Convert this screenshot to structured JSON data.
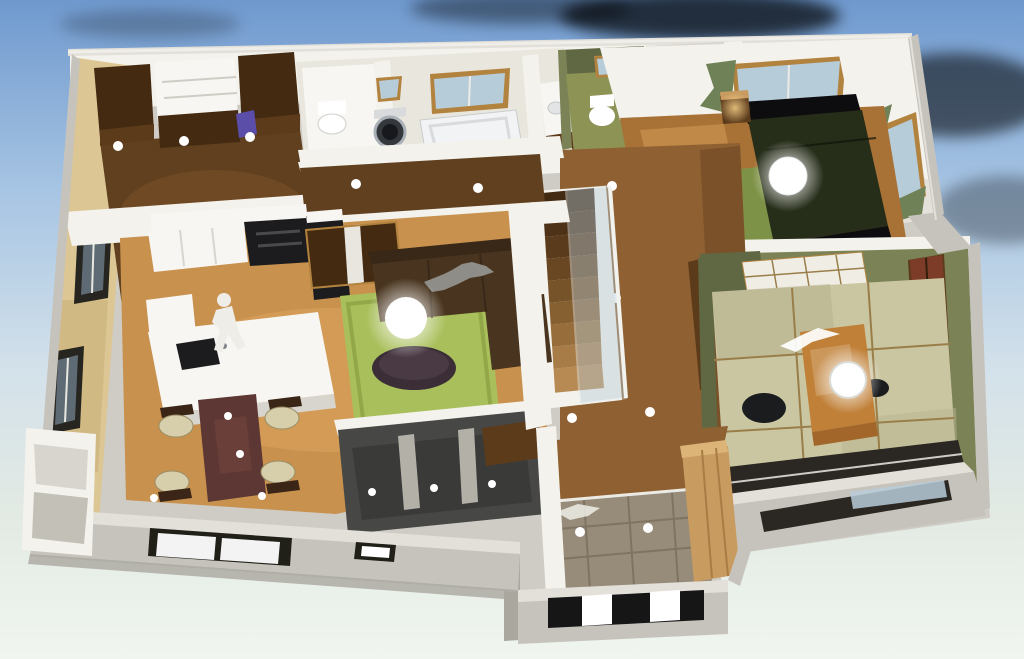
{
  "scene": {
    "type": "3d-floorplan-render",
    "objects": [
      "sky-background",
      "clouds",
      "house-slab",
      "back-wall",
      "west-bedroom",
      "wardrobe-closets",
      "shelf-unit",
      "bathroom-block",
      "toilet-room",
      "washing-machine",
      "bathtub",
      "vanity",
      "second-toilet-room",
      "stairwell-void",
      "master-bedroom",
      "bed",
      "nightstand",
      "ceiling-sphere-lamp",
      "curtained-windows",
      "tatami-room",
      "low-table",
      "floor-chairs",
      "shoji-screen",
      "closet-panels",
      "pendant-lamp",
      "crane-silhouette",
      "hallway",
      "staircase",
      "glass-balustrade",
      "kitchen",
      "kitchen-island",
      "sink",
      "person-silhouette",
      "sliding-door",
      "sofa",
      "dog-silhouette",
      "green-rug",
      "coffee-table",
      "floor-lamp-sphere",
      "dining-table",
      "dining-chairs",
      "dark-terrace",
      "entry-hall",
      "genkan-tile",
      "shoe-cabinet",
      "porch-steps",
      "front-windows",
      "corner-closet-bump",
      "downlights"
    ]
  },
  "palette": {
    "sky_top": "#6f99ce",
    "sky_upper": "#a9c6e4",
    "sky_soft": "#d3e1ea",
    "sky_horizon": "#e3eae4",
    "ground": "#f0f5ef",
    "white": "#ffffff",
    "lamp_warm": "#ffd98f",
    "cap": "#e3e0da",
    "cap_dim": "#cfccc5",
    "ext": "#c6c3bc",
    "ext_dark": "#aaa79f",
    "white_wall": "#f4f2ec",
    "wall_shade": "#d8d5ce",
    "wall_dark": "#a29e96",
    "tan_wall": "#dcc693",
    "tan_dark": "#c4a873",
    "wood_dark": "#60401f",
    "wood_dark2": "#7b5227",
    "wood_hall": "#8f6132",
    "wood_hall2": "#7a5128",
    "wood_ldk": "#c8914e",
    "wood_ldk_hi": "#e0a95f",
    "wood_ldk_sh": "#a87236",
    "closet": "#432a10",
    "closet2": "#5c3b1b",
    "white_furn": "#f7f6f2",
    "black": "#1c1c1e",
    "rug": "#a9bf5b",
    "rug_sh": "#92a748",
    "carpet": "#7e9247",
    "sofa": "#49351f",
    "sofa_dark": "#392818",
    "maroon": "#5d3733",
    "maroon_hi": "#71443e",
    "seat": "#d7cfab",
    "chair_frame": "#3a2517",
    "coffee": "#3b2e37",
    "coffee_hi": "#4a3a44",
    "tatami": "#cbc6a2",
    "tatami_sh": "#b8b38e",
    "tatami_bd": "#997e4a",
    "ttable": "#c08038",
    "ttable_sh": "#a2662a",
    "gwall": "#7b8356",
    "gwall_dark": "#5f6743",
    "gfloor": "#8d9355",
    "bed": "#0d0d0f",
    "bed_olive": "#262d19",
    "curtain": "#6f8156",
    "glass": "#b7ccd9",
    "glass_dk": "#5f6b74",
    "tile": "#978b7a",
    "tile_ln": "#7f7362",
    "shoe": "#c89b60",
    "shoe_hi": "#dcb478",
    "washer": "#34373c",
    "washer_ring": "#a9b0b8",
    "dark_room": "#474745",
    "dark_floor": "#3a3a39",
    "opening": "#2b2722",
    "amber": "#b2823f",
    "porch": "#161616",
    "sil": "#efede7",
    "dog": "#8e8d88",
    "purple": "#5a4ea8",
    "redpanel": "#7c3c28",
    "bath_floor": "#e9e6de",
    "stair0": "#b68a52",
    "stair1": "#a87c46",
    "stair2": "#976d3b",
    "stair3": "#876032",
    "stair4": "#775329",
    "stair5": "#684722",
    "stair6": "#5a3c1c",
    "stair7": "#4d3217",
    "stair8": "#422a12"
  }
}
